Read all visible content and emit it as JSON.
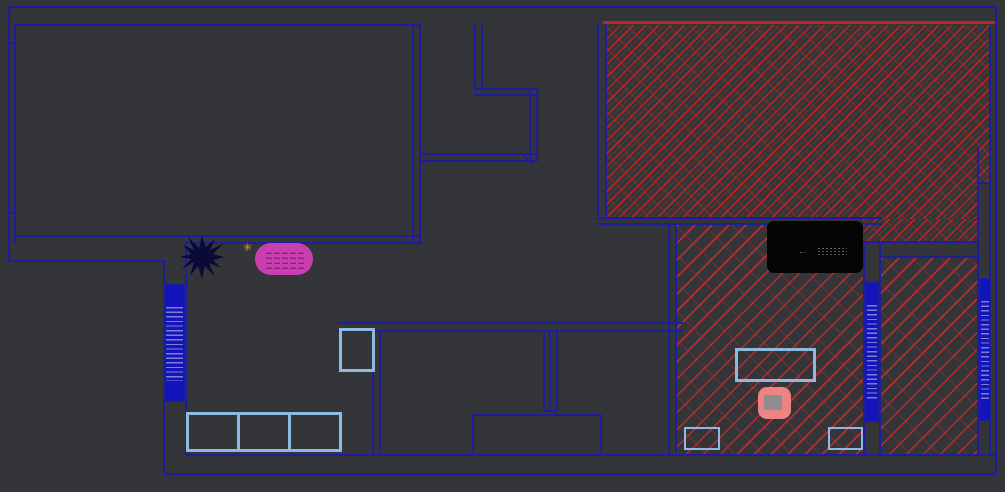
{
  "canvas": {
    "width": 1005,
    "height": 492,
    "background": "#343539"
  },
  "palette": {
    "wall_blue": "#1d1d9e",
    "hatch_red": "#c32525",
    "furniture_light_blue": "#8fb9e0",
    "radiator_blue": "#1414bb",
    "radiator_stripe": "#7f7fd2",
    "tub_magenta": "#c93eb1",
    "tub_dash": "#8e2480",
    "chair_salmon": "#ee8383",
    "chair_seat_gray": "#8e8e8e",
    "black_object": "#050505",
    "plant_navy": "#0a0a36",
    "sparkle_yellow": "#d89b1b",
    "background_gray": "#343539"
  },
  "plan": {
    "walls": [
      {
        "x": 8,
        "y": 6,
        "w": 989,
        "h": 2
      },
      {
        "x": 8,
        "y": 6,
        "w": 2,
        "h": 256
      },
      {
        "x": 8,
        "y": 260,
        "w": 157,
        "h": 2
      },
      {
        "x": 163,
        "y": 260,
        "w": 2,
        "h": 215
      },
      {
        "x": 185,
        "y": 454,
        "w": 812,
        "h": 2
      },
      {
        "x": 163,
        "y": 473,
        "w": 834,
        "h": 2
      },
      {
        "x": 995,
        "y": 6,
        "w": 2,
        "h": 469
      },
      {
        "x": 989,
        "y": 26,
        "w": 2,
        "h": 428
      },
      {
        "x": 977,
        "y": 148,
        "w": 2,
        "h": 306
      },
      {
        "x": 14,
        "y": 24,
        "w": 406,
        "h": 2
      },
      {
        "x": 14,
        "y": 24,
        "w": 2,
        "h": 219
      },
      {
        "x": 412,
        "y": 24,
        "w": 2,
        "h": 219
      },
      {
        "x": 419,
        "y": 24,
        "w": 2,
        "h": 221
      },
      {
        "x": 14,
        "y": 235,
        "w": 406,
        "h": 2
      },
      {
        "x": 185,
        "y": 242,
        "w": 235,
        "h": 2
      },
      {
        "x": 8,
        "y": 42,
        "w": 8,
        "h": 2
      },
      {
        "x": 8,
        "y": 212,
        "w": 8,
        "h": 2
      },
      {
        "x": 185,
        "y": 242,
        "w": 2,
        "h": 213
      },
      {
        "x": 474,
        "y": 24,
        "w": 2,
        "h": 66
      },
      {
        "x": 481,
        "y": 24,
        "w": 2,
        "h": 66
      },
      {
        "x": 474,
        "y": 88,
        "w": 64,
        "h": 2
      },
      {
        "x": 474,
        "y": 94,
        "w": 64,
        "h": 2
      },
      {
        "x": 529,
        "y": 88,
        "w": 2,
        "h": 74
      },
      {
        "x": 536,
        "y": 88,
        "w": 2,
        "h": 74
      },
      {
        "x": 420,
        "y": 153,
        "w": 118,
        "h": 2
      },
      {
        "x": 420,
        "y": 160,
        "w": 118,
        "h": 2
      },
      {
        "x": 337,
        "y": 322,
        "w": 346,
        "h": 2
      },
      {
        "x": 337,
        "y": 330,
        "w": 346,
        "h": 2
      },
      {
        "x": 372,
        "y": 330,
        "w": 2,
        "h": 125
      },
      {
        "x": 379,
        "y": 330,
        "w": 2,
        "h": 125
      },
      {
        "x": 543,
        "y": 330,
        "w": 2,
        "h": 82
      },
      {
        "x": 549,
        "y": 330,
        "w": 2,
        "h": 82
      },
      {
        "x": 556,
        "y": 330,
        "w": 2,
        "h": 82
      },
      {
        "x": 543,
        "y": 410,
        "w": 15,
        "h": 2
      },
      {
        "x": 472,
        "y": 414,
        "w": 130,
        "h": 2
      },
      {
        "x": 472,
        "y": 414,
        "w": 2,
        "h": 41
      },
      {
        "x": 600,
        "y": 414,
        "w": 2,
        "h": 41
      },
      {
        "x": 597,
        "y": 24,
        "w": 2,
        "h": 196
      },
      {
        "x": 605,
        "y": 24,
        "w": 2,
        "h": 196
      },
      {
        "x": 597,
        "y": 217,
        "w": 285,
        "h": 2
      },
      {
        "x": 597,
        "y": 223,
        "w": 285,
        "h": 2
      },
      {
        "x": 668,
        "y": 223,
        "w": 2,
        "h": 232
      },
      {
        "x": 675,
        "y": 223,
        "w": 2,
        "h": 232
      },
      {
        "x": 863,
        "y": 241,
        "w": 2,
        "h": 214
      },
      {
        "x": 863,
        "y": 241,
        "w": 116,
        "h": 2
      },
      {
        "x": 879,
        "y": 256,
        "w": 100,
        "h": 2
      },
      {
        "x": 879,
        "y": 241,
        "w": 2,
        "h": 214
      },
      {
        "x": 977,
        "y": 182,
        "w": 14,
        "h": 2
      }
    ],
    "red_lines": [
      {
        "x": 603,
        "y": 21,
        "w": 392,
        "h": 3
      }
    ],
    "hatch_areas": [
      {
        "name": "tiled-floor-top-right",
        "x": 607,
        "y": 25,
        "w": 384,
        "h": 194,
        "density": "dense"
      },
      {
        "name": "tiled-floor-top-right-ext",
        "x": 863,
        "y": 219,
        "w": 128,
        "h": 22,
        "density": "dense"
      },
      {
        "name": "tiled-floor-bottom-right",
        "x": 677,
        "y": 225,
        "w": 186,
        "h": 229,
        "density": "sparse"
      },
      {
        "name": "tiled-floor-right-room",
        "x": 881,
        "y": 258,
        "w": 96,
        "h": 196,
        "density": "sparse"
      }
    ],
    "covers": [
      {
        "name": "duct-shaft",
        "x": 979,
        "y": 184,
        "w": 10,
        "h": 93
      }
    ],
    "diagonals": [
      {
        "name": "door-swing",
        "x": 522,
        "y": 153,
        "len": 15,
        "deg": 45
      }
    ],
    "radiators": [
      {
        "name": "radiator-left",
        "x": 164,
        "y": 284,
        "w": 21,
        "h": 118
      },
      {
        "name": "radiator-mid-right",
        "x": 865,
        "y": 282,
        "w": 14,
        "h": 140
      },
      {
        "name": "radiator-far-right",
        "x": 979,
        "y": 278,
        "w": 12,
        "h": 143
      }
    ],
    "furniture_outlines": [
      {
        "name": "cabinet-box",
        "x": 339,
        "y": 328,
        "w": 36,
        "h": 44,
        "t": 3
      },
      {
        "name": "table",
        "x": 735,
        "y": 348,
        "w": 81,
        "h": 34,
        "t": 3
      },
      {
        "name": "cabinet-small-left",
        "x": 684,
        "y": 427,
        "w": 36,
        "h": 23,
        "t": 2
      },
      {
        "name": "cabinet-small-right",
        "x": 828,
        "y": 427,
        "w": 35,
        "h": 23,
        "t": 2
      }
    ],
    "wardrobe": {
      "x": 186,
      "y": 412,
      "w": 156,
      "h": 40,
      "cells": 3
    },
    "black_box": {
      "x": 767,
      "y": 221,
      "w": 96,
      "h": 52
    },
    "tub": {
      "x": 255,
      "y": 243,
      "w": 58,
      "h": 32
    },
    "sparkle": {
      "x": 243,
      "y": 242,
      "glyph": "✳"
    },
    "plant": {
      "x": 180,
      "y": 235,
      "w": 45,
      "h": 45,
      "points": "22,1 26,12 35,4 30,15 43,9 33,19 44,22 33,25 41,33 29,28 35,42 25,31 22,44 18,31 10,41 14,27 2,34 11,24 0,22 11,19 3,10 14,15 8,2 19,13"
    },
    "chair": {
      "x": 758,
      "y": 387,
      "w": 33,
      "h": 32
    }
  }
}
